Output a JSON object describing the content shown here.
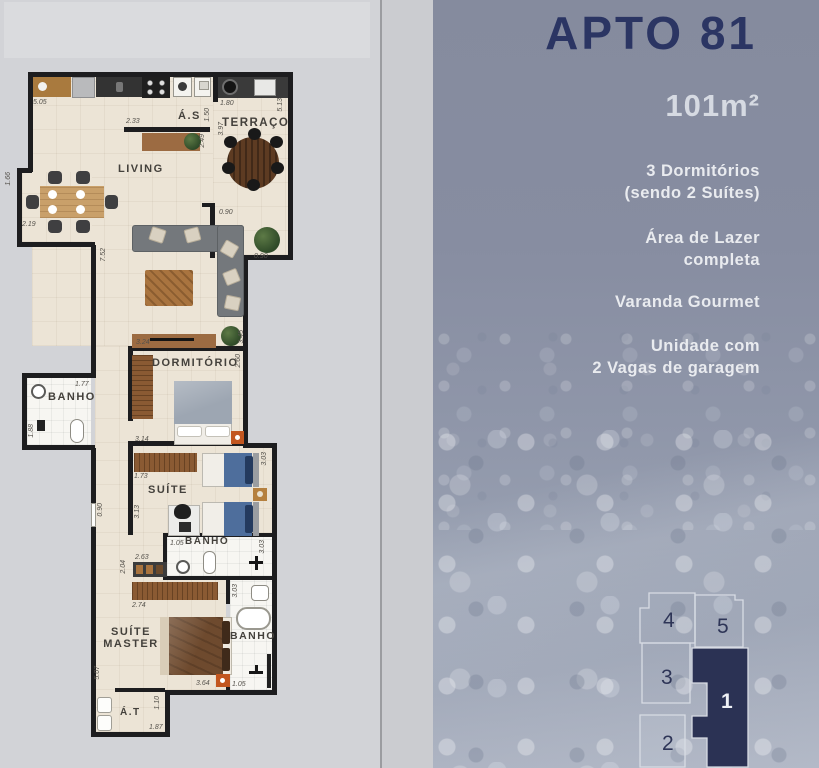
{
  "plan": {
    "rooms": [
      "Á.S",
      "TERRAÇO",
      "LIVING",
      "BANHO",
      "DORMITÓRIO",
      "SUÍTE",
      "BANHO",
      "SUÍTE\nMASTER",
      "BANHO",
      "Á.T"
    ],
    "dims": [
      "5.05",
      "2.33",
      "1.50",
      "2.49",
      "3.97",
      "1.80",
      "5.13",
      "0.90",
      "1.66",
      "2.19",
      "7.52",
      "0.90",
      "3.24",
      "3.45",
      "2.60",
      "1.77",
      "1.88",
      "3.14",
      "1.73",
      "3.03",
      "0.90",
      "3.13",
      "1.05",
      "3.03",
      "2.63",
      "2.04",
      "2.74",
      "3.03",
      "5.07",
      "3.64",
      "1.05",
      "1.10",
      "1.87"
    ]
  },
  "right_panel": {
    "title": "APTO 81",
    "area": "101m²",
    "features": [
      "3 Dormitórios\n(sendo 2 Suítes)",
      "Área de Lazer\ncompleta",
      "Varanda Gourmet",
      "Unidade com\n2 Vagas de garagem"
    ],
    "keyplan": {
      "units": [
        "4",
        "5",
        "3",
        "1",
        "2"
      ],
      "highlighted": "1"
    }
  },
  "colors": {
    "title_navy": "#2b3563",
    "keyplan_highlight": "#2b3254",
    "ocean_base": "#8a91a5",
    "floor_beige": "#ece4d6",
    "wall_black": "#1d1d1f",
    "accent_orange": "#c2561f"
  }
}
